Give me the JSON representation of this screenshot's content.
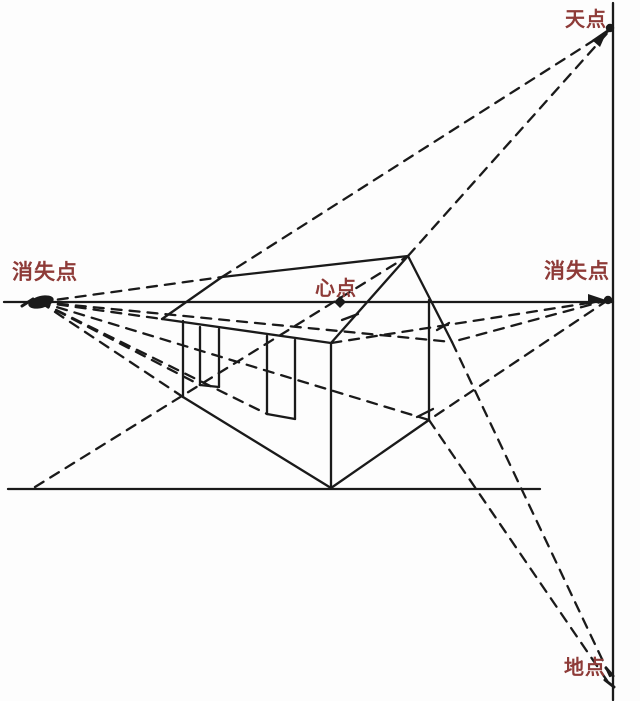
{
  "canvas": {
    "width": 640,
    "height": 701,
    "background": "#fdfdfd"
  },
  "colors": {
    "line": "#1a1a1a",
    "label": "#8e3b38"
  },
  "labels": [
    {
      "id": "vanishing-point-left-label",
      "text": "消失点",
      "x": 45,
      "y": 279,
      "size": 21
    },
    {
      "id": "vanishing-point-right-label",
      "text": "消失点",
      "x": 577,
      "y": 278,
      "size": 21
    },
    {
      "id": "center-point-label",
      "text": "心点",
      "x": 336,
      "y": 295,
      "size": 20
    },
    {
      "id": "sky-point-label",
      "text": "天点",
      "x": 586,
      "y": 26,
      "size": 20
    },
    {
      "id": "ground-point-label",
      "text": "地点",
      "x": 585,
      "y": 674,
      "size": 20
    }
  ],
  "points": [
    {
      "name": "vanishing-point-left-dot",
      "x": 41,
      "y": 302,
      "type": "blob"
    },
    {
      "name": "vanishing-point-right-dot",
      "x": 608,
      "y": 300,
      "type": "dot-arrow-right"
    },
    {
      "name": "center-point-dot",
      "x": 340,
      "y": 302,
      "type": "diamond"
    },
    {
      "name": "sky-point-dot",
      "x": 610,
      "y": 28,
      "type": "dot-arrow-up"
    },
    {
      "name": "ground-point-marks",
      "x": 610,
      "y": 678,
      "type": "scribble"
    }
  ],
  "solid_lines": [
    {
      "name": "horizon-line",
      "x1": 4,
      "y1": 302,
      "x2": 613,
      "y2": 302
    },
    {
      "name": "vertical-right-line",
      "x1": 613,
      "y1": 3,
      "x2": 613,
      "y2": 700
    },
    {
      "name": "ground-line",
      "x1": 8,
      "y1": 489,
      "x2": 540,
      "y2": 489
    },
    {
      "name": "house-ridge",
      "x1": 222,
      "y1": 277,
      "x2": 408,
      "y2": 256
    },
    {
      "name": "house-roof-left-edge",
      "x1": 222,
      "y1": 277,
      "x2": 162,
      "y2": 319
    },
    {
      "name": "house-eaves-front-edge",
      "x1": 162,
      "y1": 319,
      "x2": 331,
      "y2": 343
    },
    {
      "name": "house-gable-left-slope",
      "x1": 408,
      "y1": 256,
      "x2": 331,
      "y2": 343
    },
    {
      "name": "house-gable-right-slope",
      "x1": 408,
      "y1": 256,
      "x2": 452,
      "y2": 342
    },
    {
      "name": "house-front-corner",
      "x1": 331,
      "y1": 343,
      "x2": 331,
      "y2": 488
    },
    {
      "name": "house-right-corner",
      "x1": 429,
      "y1": 300,
      "x2": 429,
      "y2": 420
    },
    {
      "name": "house-gable-bottom-edge",
      "x1": 331,
      "y1": 488,
      "x2": 429,
      "y2": 420
    },
    {
      "name": "house-wall-bottom-edge",
      "x1": 331,
      "y1": 488,
      "x2": 183,
      "y2": 397
    },
    {
      "name": "house-wall-left-edge",
      "x1": 183,
      "y1": 321,
      "x2": 183,
      "y2": 397
    },
    {
      "name": "window1-left-edge",
      "x1": 200,
      "y1": 327,
      "x2": 200,
      "y2": 385
    },
    {
      "name": "window1-right-edge",
      "x1": 219,
      "y1": 329,
      "x2": 219,
      "y2": 387
    },
    {
      "name": "window1-sill",
      "x1": 200,
      "y1": 385,
      "x2": 219,
      "y2": 387
    },
    {
      "name": "window2-left-edge",
      "x1": 267,
      "y1": 336,
      "x2": 267,
      "y2": 414
    },
    {
      "name": "window2-right-edge",
      "x1": 295,
      "y1": 340,
      "x2": 295,
      "y2": 419
    },
    {
      "name": "window2-sill",
      "x1": 267,
      "y1": 414,
      "x2": 295,
      "y2": 419
    },
    {
      "name": "tick-gable-right-slope",
      "x1": 437,
      "y1": 330,
      "x2": 449,
      "y2": 323
    },
    {
      "name": "tick-gable-left-slope",
      "x1": 342,
      "y1": 320,
      "x2": 358,
      "y2": 314
    },
    {
      "name": "tick-bottom-right-corner",
      "x1": 417,
      "y1": 417,
      "x2": 433,
      "y2": 409
    }
  ],
  "dashed_lines": [
    {
      "name": "apex-to-sky-point",
      "x1": 408,
      "y1": 256,
      "x2": 610,
      "y2": 30
    },
    {
      "name": "ridge-end-to-sky-point",
      "x1": 222,
      "y1": 277,
      "x2": 610,
      "y2": 30
    },
    {
      "name": "left-vp-to-right-eaves",
      "x1": 40,
      "y1": 302,
      "x2": 452,
      "y2": 342
    },
    {
      "name": "left-vp-to-right-bottom",
      "x1": 40,
      "y1": 302,
      "x2": 429,
      "y2": 420
    },
    {
      "name": "left-vp-to-window2-sill",
      "x1": 40,
      "y1": 302,
      "x2": 267,
      "y2": 414
    },
    {
      "name": "left-vp-to-window1-sill",
      "x1": 40,
      "y1": 302,
      "x2": 200,
      "y2": 385
    },
    {
      "name": "left-vp-to-wall-bottom",
      "x1": 40,
      "y1": 302,
      "x2": 183,
      "y2": 397
    },
    {
      "name": "left-vp-to-eaves-corner",
      "x1": 40,
      "y1": 302,
      "x2": 162,
      "y2": 319
    },
    {
      "name": "left-vp-to-ridge-end",
      "x1": 40,
      "y1": 302,
      "x2": 222,
      "y2": 277
    },
    {
      "name": "right-vp-to-front-eaves",
      "x1": 608,
      "y1": 300,
      "x2": 331,
      "y2": 343
    },
    {
      "name": "right-vp-to-right-eaves",
      "x1": 608,
      "y1": 300,
      "x2": 452,
      "y2": 342
    },
    {
      "name": "right-vp-to-right-bottom",
      "x1": 608,
      "y1": 300,
      "x2": 429,
      "y2": 420
    },
    {
      "name": "eaves-to-ground-point",
      "x1": 452,
      "y1": 342,
      "x2": 610,
      "y2": 676
    },
    {
      "name": "corner-to-ground-point",
      "x1": 429,
      "y1": 420,
      "x2": 610,
      "y2": 685
    },
    {
      "name": "groundline-to-apex-diagonal",
      "x1": 35,
      "y1": 487,
      "x2": 408,
      "y2": 256
    }
  ]
}
